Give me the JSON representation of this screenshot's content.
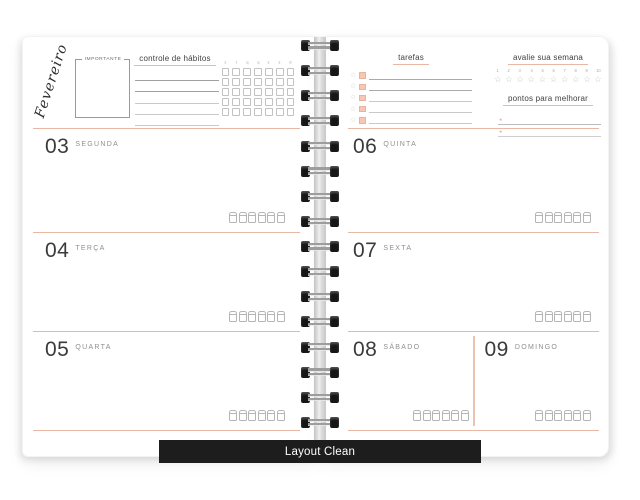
{
  "product_label": "Layout Clean",
  "month_label": "Fevereiro",
  "left_page": {
    "important_label": "IMPORTANTE",
    "habit_tracker": {
      "title": "controle de hábitos",
      "day_headers": [
        "s",
        "t",
        "q",
        "q",
        "s",
        "s",
        "d"
      ]
    },
    "days": [
      {
        "number": "03",
        "name": "SEGUNDA"
      },
      {
        "number": "04",
        "name": "TERÇA"
      },
      {
        "number": "05",
        "name": "QUARTA"
      }
    ]
  },
  "right_page": {
    "tasks_title": "tarefas",
    "week_review": {
      "title": "avalie sua semana",
      "scale": [
        "1",
        "2",
        "3",
        "4",
        "5",
        "6",
        "7",
        "8",
        "9",
        "10"
      ]
    },
    "improve_title": "pontos para melhorar",
    "days": [
      {
        "number": "06",
        "name": "QUINTA"
      },
      {
        "number": "07",
        "name": "SEXTA"
      },
      {
        "number": "08",
        "name": "SÁBADO"
      },
      {
        "number": "09",
        "name": "DOMINGO"
      }
    ]
  },
  "colors": {
    "accent": "#e9b7a3",
    "accent_fill": "#f5c7b4",
    "line_gray": "#b5b5b5",
    "text_dark": "#3b3b3b",
    "label_bg": "#1d1d1d"
  }
}
